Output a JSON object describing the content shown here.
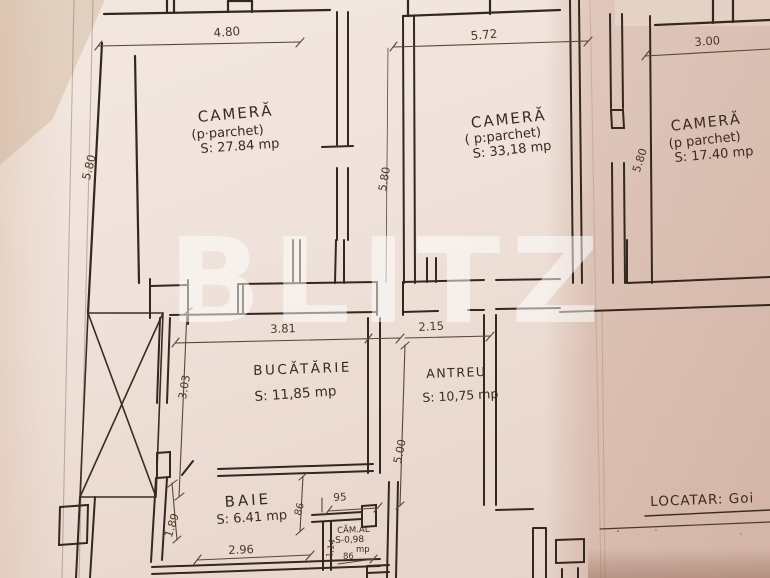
{
  "watermark": "BLITZ",
  "rooms": {
    "camera_left": {
      "name": "CAMERĂ",
      "finish": "(p·parchet)",
      "area": "S: 27.84 mp"
    },
    "camera_mid": {
      "name": "CAMERĂ",
      "finish": "( p:parchet)",
      "area": "S: 33,18 mp"
    },
    "camera_right": {
      "name": "CAMERĂ",
      "finish": "(p parchet)",
      "area": "S: 17.40 mp"
    },
    "bucatarie": {
      "name": "BUCĂTĂRIE",
      "area": "S: 11,85 mp"
    },
    "antreu": {
      "name": "ANTREU",
      "area": "S: 10,75 mp"
    },
    "baie": {
      "name": "BAIE",
      "area": "S: 6.41 mp"
    },
    "camara": {
      "name": "CĂM.AL",
      "area": "S-0,98",
      "unit": "mp",
      "width_note": "86"
    }
  },
  "dimensions": {
    "top_left": "4.80",
    "top_mid": "5.72",
    "top_right": "3.00",
    "left_height": "5.80",
    "mid_height": "5.80",
    "right_height": "5.80",
    "kitchen_width": "3.81",
    "antreu_width": "2.15",
    "kitchen_height": "3.03",
    "antreu_height": "5.00",
    "baie_height": "1.89",
    "baie_width": "2.96",
    "camara_top": "95",
    "baie_right": "86",
    "camara_side": "1,14"
  },
  "footer": {
    "locatar": "LOCATAR: Goi"
  }
}
